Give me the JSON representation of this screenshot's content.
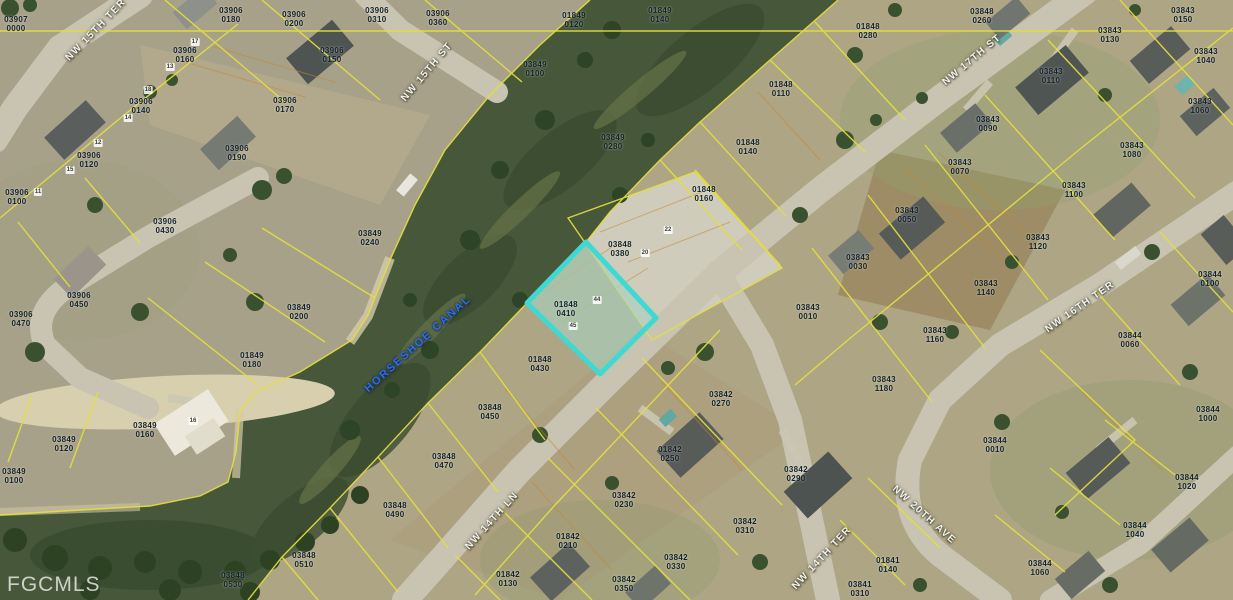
{
  "watermark": {
    "label": "FGCMLS"
  },
  "map": {
    "highlight": {
      "parcel": "01848 0410",
      "outline_color": "#3fd8d2"
    },
    "street_labels": [
      {
        "name": "NW 15TH TER",
        "x": 96,
        "y": 30,
        "rot": -46,
        "kind": "street"
      },
      {
        "name": "NW 15TH ST",
        "x": 427,
        "y": 72,
        "rot": -50,
        "kind": "street"
      },
      {
        "name": "NW 17TH ST",
        "x": 972,
        "y": 60,
        "rot": -40,
        "kind": "street"
      },
      {
        "name": "NW 16TH TER",
        "x": 1080,
        "y": 307,
        "rot": -35,
        "kind": "street"
      },
      {
        "name": "NW 14TH LN",
        "x": 492,
        "y": 521,
        "rot": -48,
        "kind": "street"
      },
      {
        "name": "NW 14TH TER",
        "x": 822,
        "y": 558,
        "rot": -47,
        "kind": "street"
      },
      {
        "name": "NW 20TH AVE",
        "x": 924,
        "y": 515,
        "rot": 42,
        "kind": "street"
      },
      {
        "name": "HORSESHOE CANAL",
        "x": 418,
        "y": 344,
        "rot": -42,
        "kind": "canal"
      }
    ],
    "parcel_labels": [
      {
        "id": "03907 0000",
        "x": 16,
        "y": 24
      },
      {
        "id": "03906 0180",
        "x": 231,
        "y": 15
      },
      {
        "id": "03906 0200",
        "x": 294,
        "y": 19
      },
      {
        "id": "03906 0310",
        "x": 377,
        "y": 15
      },
      {
        "id": "03906 0360",
        "x": 438,
        "y": 18
      },
      {
        "id": "03906 0160",
        "x": 185,
        "y": 55
      },
      {
        "id": "03906 0150",
        "x": 332,
        "y": 55
      },
      {
        "id": "03906 0140",
        "x": 141,
        "y": 106
      },
      {
        "id": "03906 0170",
        "x": 285,
        "y": 105
      },
      {
        "id": "03906 0190",
        "x": 237,
        "y": 153
      },
      {
        "id": "03906 0120",
        "x": 89,
        "y": 160
      },
      {
        "id": "03906 0100",
        "x": 17,
        "y": 197
      },
      {
        "id": "03906 0430",
        "x": 165,
        "y": 226
      },
      {
        "id": "03906 0450",
        "x": 79,
        "y": 300
      },
      {
        "id": "03906 0470",
        "x": 21,
        "y": 319
      },
      {
        "id": "01849 0120",
        "x": 574,
        "y": 20
      },
      {
        "id": "01849 0140",
        "x": 660,
        "y": 15
      },
      {
        "id": "03849 0100",
        "x": 535,
        "y": 69
      },
      {
        "id": "03849 0280",
        "x": 613,
        "y": 142
      },
      {
        "id": "03849 0240",
        "x": 370,
        "y": 238
      },
      {
        "id": "03849 0200",
        "x": 299,
        "y": 312
      },
      {
        "id": "01849 0180",
        "x": 252,
        "y": 360
      },
      {
        "id": "03849 0160",
        "x": 145,
        "y": 430
      },
      {
        "id": "03849 0120",
        "x": 64,
        "y": 444
      },
      {
        "id": "03849 0100",
        "x": 14,
        "y": 476
      },
      {
        "id": "01848 0280",
        "x": 868,
        "y": 31
      },
      {
        "id": "03848 0260",
        "x": 982,
        "y": 16
      },
      {
        "id": "01848 0110",
        "x": 781,
        "y": 89
      },
      {
        "id": "01848 0140",
        "x": 748,
        "y": 147
      },
      {
        "id": "01848 0160",
        "x": 704,
        "y": 194
      },
      {
        "id": "03848 0380",
        "x": 620,
        "y": 249
      },
      {
        "id": "01848 0410",
        "x": 566,
        "y": 309
      },
      {
        "id": "01848 0430",
        "x": 540,
        "y": 364
      },
      {
        "id": "03848 0450",
        "x": 490,
        "y": 412
      },
      {
        "id": "03848 0470",
        "x": 444,
        "y": 461
      },
      {
        "id": "03848 0490",
        "x": 395,
        "y": 510
      },
      {
        "id": "03848 0510",
        "x": 304,
        "y": 560
      },
      {
        "id": "03848 0530",
        "x": 233,
        "y": 580
      },
      {
        "id": "03843 0150",
        "x": 1183,
        "y": 15
      },
      {
        "id": "03843 0130",
        "x": 1110,
        "y": 35
      },
      {
        "id": "03843 1040",
        "x": 1206,
        "y": 56
      },
      {
        "id": "03843 0110",
        "x": 1051,
        "y": 76
      },
      {
        "id": "03843 1060",
        "x": 1200,
        "y": 106
      },
      {
        "id": "03843 0090",
        "x": 988,
        "y": 124
      },
      {
        "id": "03843 1080",
        "x": 1132,
        "y": 150
      },
      {
        "id": "03843 0070",
        "x": 960,
        "y": 167
      },
      {
        "id": "03843 1100",
        "x": 1074,
        "y": 190
      },
      {
        "id": "03843 0050",
        "x": 907,
        "y": 215
      },
      {
        "id": "03843 1120",
        "x": 1038,
        "y": 242
      },
      {
        "id": "03843 0030",
        "x": 858,
        "y": 262
      },
      {
        "id": "03843 1140",
        "x": 986,
        "y": 288
      },
      {
        "id": "03843 0010",
        "x": 808,
        "y": 312
      },
      {
        "id": "03843 1160",
        "x": 935,
        "y": 335
      },
      {
        "id": "03843 1180",
        "x": 884,
        "y": 384
      },
      {
        "id": "03844 0100",
        "x": 1210,
        "y": 279
      },
      {
        "id": "03844 0060",
        "x": 1130,
        "y": 340
      },
      {
        "id": "03844 0010",
        "x": 995,
        "y": 445
      },
      {
        "id": "03844 1000",
        "x": 1208,
        "y": 414
      },
      {
        "id": "03844 1020",
        "x": 1187,
        "y": 482
      },
      {
        "id": "03844 1040",
        "x": 1135,
        "y": 530
      },
      {
        "id": "03844 1060",
        "x": 1040,
        "y": 568
      },
      {
        "id": "03842 0270",
        "x": 721,
        "y": 399
      },
      {
        "id": "01842 0250",
        "x": 670,
        "y": 454
      },
      {
        "id": "03842 0230",
        "x": 624,
        "y": 500
      },
      {
        "id": "01842 0210",
        "x": 568,
        "y": 541
      },
      {
        "id": "01842 0130",
        "x": 508,
        "y": 579
      },
      {
        "id": "03842 0290",
        "x": 796,
        "y": 474
      },
      {
        "id": "03842 0310",
        "x": 745,
        "y": 526
      },
      {
        "id": "03842 0330",
        "x": 676,
        "y": 562
      },
      {
        "id": "03842 0350",
        "x": 624,
        "y": 584
      },
      {
        "id": "01841 0140",
        "x": 888,
        "y": 565
      },
      {
        "id": "03841 0310",
        "x": 860,
        "y": 589
      }
    ],
    "lot_markers": [
      {
        "n": "17",
        "x": 195,
        "y": 42
      },
      {
        "n": "13",
        "x": 170,
        "y": 67
      },
      {
        "n": "18",
        "x": 148,
        "y": 90
      },
      {
        "n": "14",
        "x": 128,
        "y": 118
      },
      {
        "n": "12",
        "x": 98,
        "y": 143
      },
      {
        "n": "15",
        "x": 70,
        "y": 170
      },
      {
        "n": "11",
        "x": 38,
        "y": 192
      },
      {
        "n": "16",
        "x": 193,
        "y": 421
      },
      {
        "n": "44",
        "x": 597,
        "y": 300
      },
      {
        "n": "45",
        "x": 573,
        "y": 326
      },
      {
        "n": "22",
        "x": 668,
        "y": 230
      },
      {
        "n": "20",
        "x": 645,
        "y": 253
      }
    ]
  }
}
